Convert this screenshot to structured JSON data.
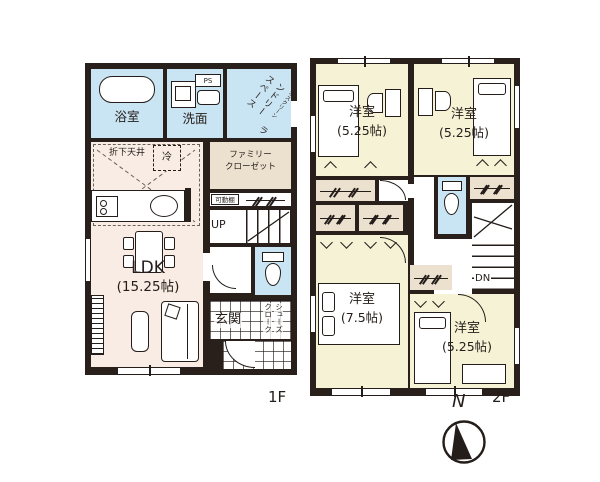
{
  "colors": {
    "wall": "#2a201b",
    "wet_room_blue": "#c9e4f2",
    "ldk_pink": "#f9ece4",
    "closet_beige": "#ece1cf",
    "bedroom_yellow": "#f5f2d6"
  },
  "floor1": {
    "floor_label": "1F",
    "bath": "浴室",
    "washroom": "洗面",
    "ps": "PS",
    "laundry_note": "ホスクリーン",
    "laundry_line1": "ランドリー",
    "laundry_line2": "スペース",
    "dropped_ceiling": "折下天井",
    "fridge": "冷",
    "family_closet_line1": "ファミリー",
    "family_closet_line2": "クローゼット",
    "movable_shelf": "可動棚",
    "stairs": "UP",
    "ldk_name": "LDK",
    "ldk_size": "(15.25帖)",
    "entrance": "玄関",
    "shoe_closet_line1": "シューズ",
    "shoe_closet_line2": "クローク"
  },
  "floor2": {
    "floor_label": "2F",
    "bedroom_nw": {
      "name": "洋室",
      "size": "(5.25帖)"
    },
    "bedroom_ne": {
      "name": "洋室",
      "size": "(5.25帖)"
    },
    "bedroom_sw": {
      "name": "洋室",
      "size": "(7.5帖)"
    },
    "bedroom_se": {
      "name": "洋室",
      "size": "(5.25帖)"
    },
    "stairs": "DN"
  },
  "compass": {
    "label": "N"
  }
}
